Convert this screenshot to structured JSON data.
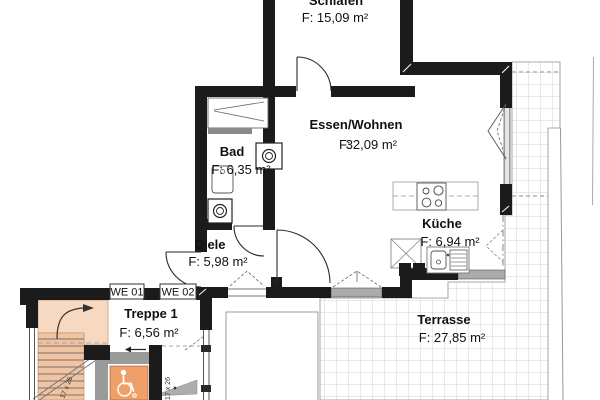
{
  "title": "Wohnungsgrundriss WE 02",
  "rooms": {
    "schlafen": {
      "name": "Schlafen",
      "area_label": "F: 15,09 m²"
    },
    "essen": {
      "name": "Essen/Wohnen",
      "f_label": "F:",
      "area_value": "32,09 m²"
    },
    "bad": {
      "name": "Bad",
      "area_label": "F: 6,35 m²"
    },
    "diele": {
      "name": "Diele",
      "area_label": "F: 5,98 m²"
    },
    "kueche": {
      "name": "Küche",
      "area_label": "F: 6,94 m²"
    },
    "treppe": {
      "name": "Treppe 1",
      "area_label": "F: 6,56 m²"
    },
    "terrasse": {
      "name": "Terrasse",
      "area_label": "F: 27,85 m²"
    }
  },
  "units": {
    "we01": "WE 01",
    "we02": "WE 02"
  },
  "annotations": {
    "stair_dim_lower": "17 x 26",
    "stair_dim_entry": "17 x 26"
  },
  "colors": {
    "wall": "#1b1b1b",
    "stair_fill": "#f0c3a3",
    "stair_fill_light": "#f6d9c0",
    "lobby_orange": "#ef9f68",
    "partition_gray": "#9a9a9a",
    "sill_gray": "#ababab",
    "tile_line": "#c9c9c9"
  }
}
